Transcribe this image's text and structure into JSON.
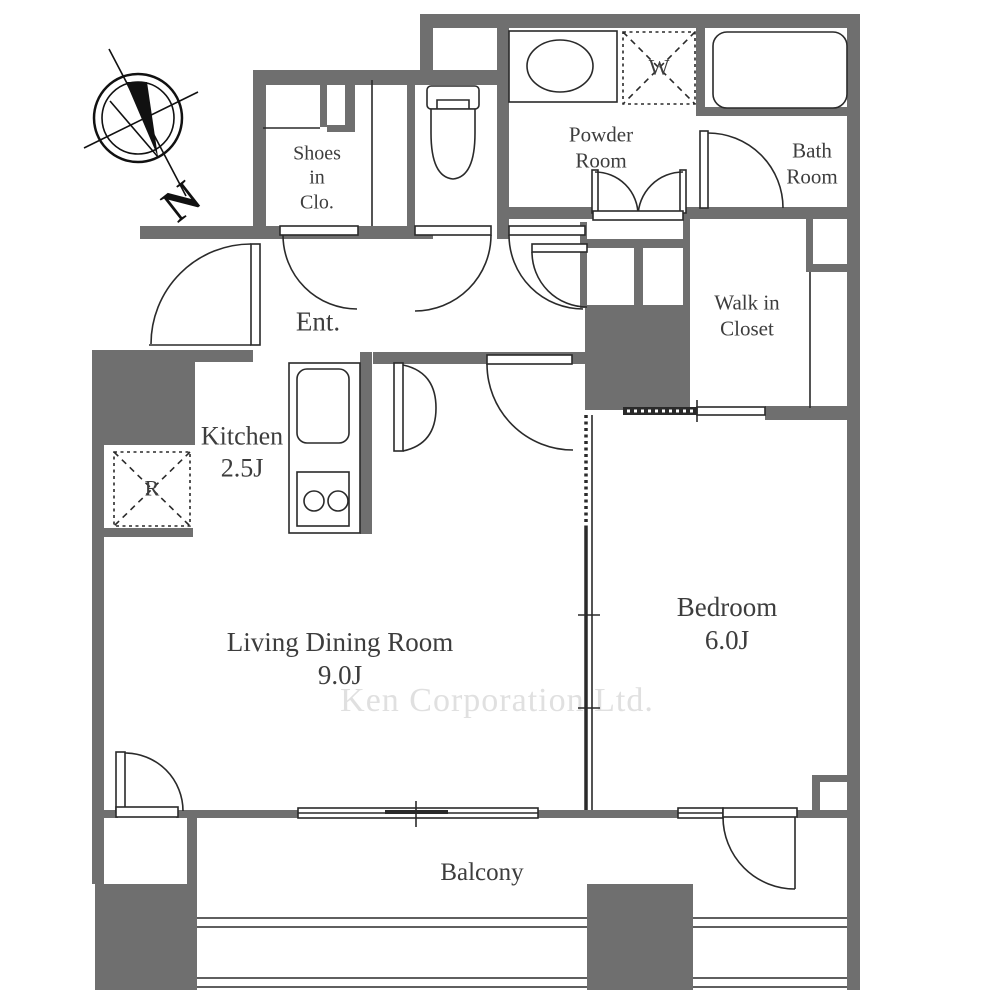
{
  "plan": {
    "title": "apartment-floor-plan",
    "compass_label": "N",
    "watermark": "Ken Corporation Ltd.",
    "rooms": {
      "shoes_closet": {
        "label": "Shoes\nin\nClo."
      },
      "powder_room": {
        "label": "Powder\nRoom"
      },
      "bath_room": {
        "label": "Bath\nRoom"
      },
      "entrance": {
        "label": "Ent."
      },
      "walk_in_closet": {
        "label": "Walk in\nCloset"
      },
      "kitchen": {
        "label": "Kitchen\n2.5J"
      },
      "living_dining": {
        "label": "Living Dining Room\n9.0J"
      },
      "bedroom": {
        "label": "Bedroom\n6.0J"
      },
      "balcony": {
        "label": "Balcony"
      }
    },
    "fixtures": {
      "washing_machine": {
        "label": "W"
      },
      "refrigerator": {
        "label": "R"
      }
    },
    "colors": {
      "wall": "#6f6f6f",
      "line": "#2a2a2a",
      "label": "#3d3d3d",
      "watermark": "#e0e0e0"
    }
  }
}
